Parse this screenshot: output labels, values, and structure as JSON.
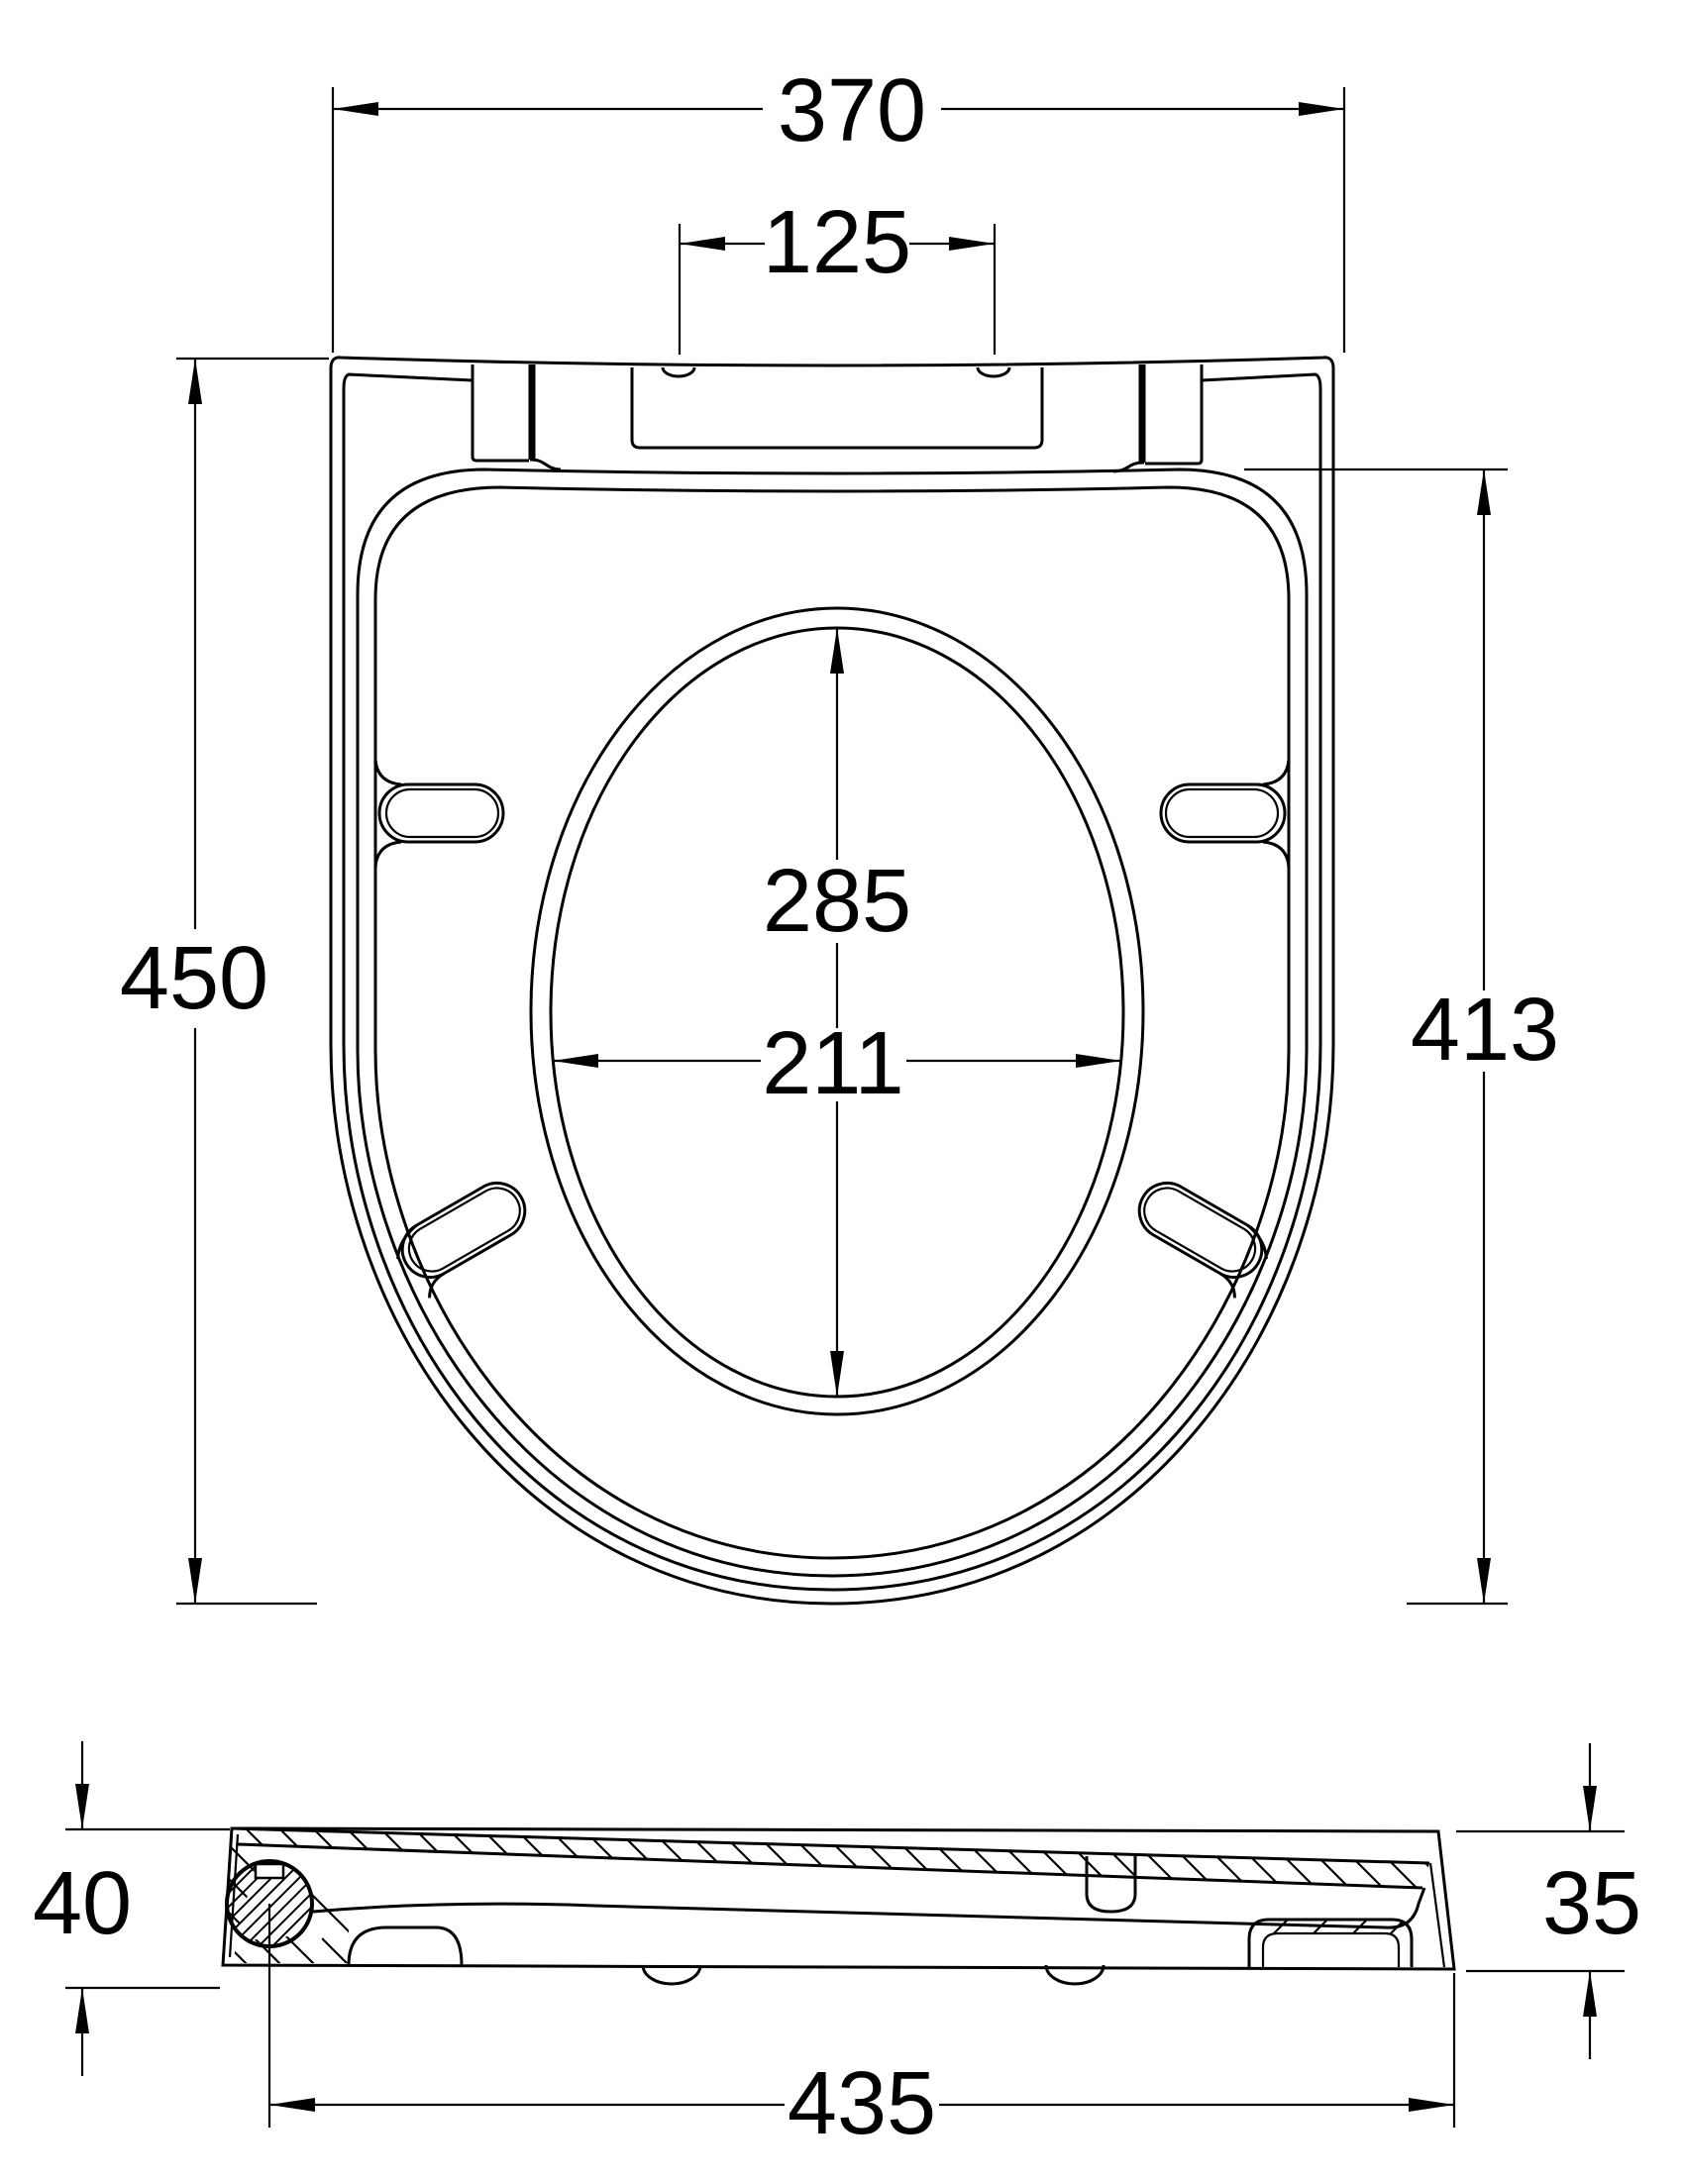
{
  "drawing_title": "Toilet seat dimension drawing",
  "colors": {
    "line": "#000000",
    "background": "#ffffff"
  },
  "top_view": {
    "dim_overall_width": "370",
    "dim_hinge_hole_spacing": "125",
    "dim_overall_depth": "450",
    "dim_depth_to_hinge": "413",
    "dim_cutout_length": "285",
    "dim_cutout_width": "211"
  },
  "side_view": {
    "dim_rear_thickness": "40",
    "dim_front_thickness": "35",
    "dim_overall_length": "435"
  }
}
